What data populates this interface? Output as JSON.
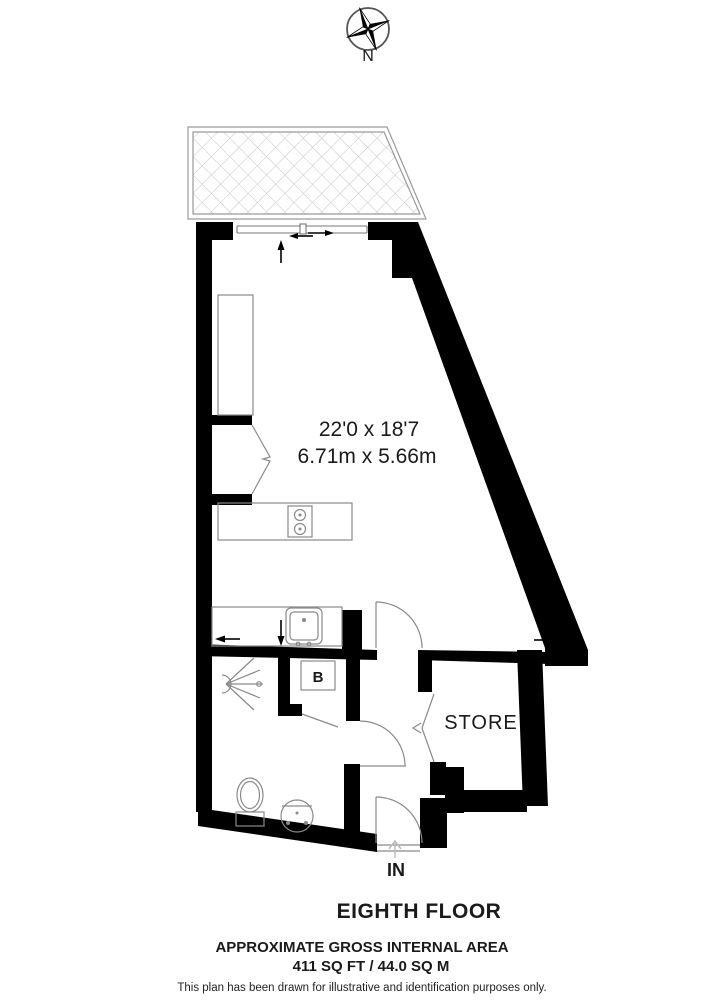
{
  "compass": {
    "north_label": "N"
  },
  "floorplan": {
    "main_room": {
      "dimensions_imperial": "22'0 x 18'7",
      "dimensions_metric": "6.71m x 5.66m"
    },
    "labels": {
      "store": "STORE",
      "boiler": "B",
      "entrance": "IN"
    }
  },
  "footer": {
    "floor_title": "EIGHTH FLOOR",
    "area_heading": "APPROXIMATE GROSS INTERNAL AREA",
    "area_value": "411 SQ FT / 44.0 SQ M",
    "disclaimer": "This plan has been drawn for illustrative and identification purposes only."
  },
  "icons": {
    "compass": "compass-rose-icon",
    "hob": "hob-icon",
    "sink": "sink-icon",
    "shower": "shower-head-icon",
    "toilet": "toilet-icon",
    "basin": "basin-icon",
    "doors": "door-swing-icon",
    "entry": "entry-arrow-icon"
  },
  "colors": {
    "wall": "#000000",
    "fixture_line": "#8a8a8a",
    "hatch": "#c6c6c6",
    "text": "#1a1a1a"
  }
}
